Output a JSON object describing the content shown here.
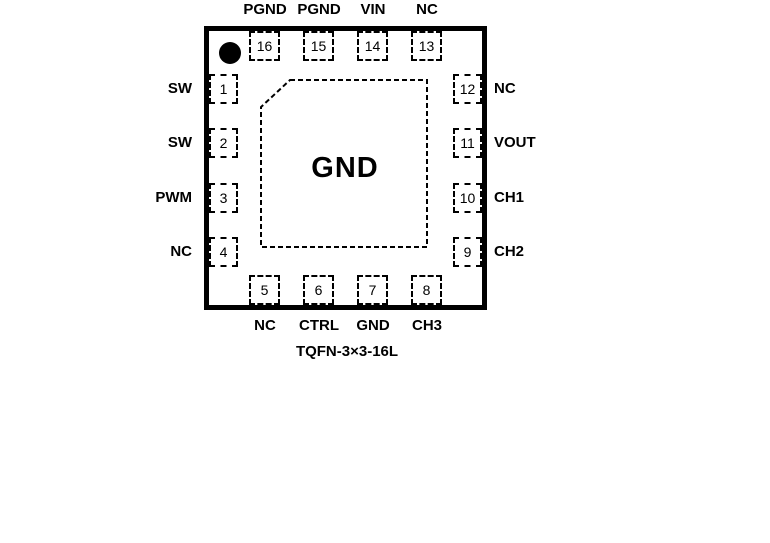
{
  "diagram": {
    "center_pad_label": "GND",
    "package_name": "TQFN-3×3-16L"
  },
  "pins": {
    "top": [
      {
        "num": "16",
        "label": "PGND"
      },
      {
        "num": "15",
        "label": "PGND"
      },
      {
        "num": "14",
        "label": "VIN"
      },
      {
        "num": "13",
        "label": "NC"
      }
    ],
    "left": [
      {
        "num": "1",
        "label": "SW"
      },
      {
        "num": "2",
        "label": "SW"
      },
      {
        "num": "3",
        "label": "PWM"
      },
      {
        "num": "4",
        "label": "NC"
      }
    ],
    "right": [
      {
        "num": "12",
        "label": "NC"
      },
      {
        "num": "11",
        "label": "VOUT"
      },
      {
        "num": "10",
        "label": "CH1"
      },
      {
        "num": "9",
        "label": "CH2"
      }
    ],
    "bottom": [
      {
        "num": "5",
        "label": "NC"
      },
      {
        "num": "6",
        "label": "CTRL"
      },
      {
        "num": "7",
        "label": "GND"
      },
      {
        "num": "8",
        "label": "CH3"
      }
    ]
  },
  "colors": {
    "line": "#000000",
    "background": "#ffffff",
    "text": "#000000"
  }
}
